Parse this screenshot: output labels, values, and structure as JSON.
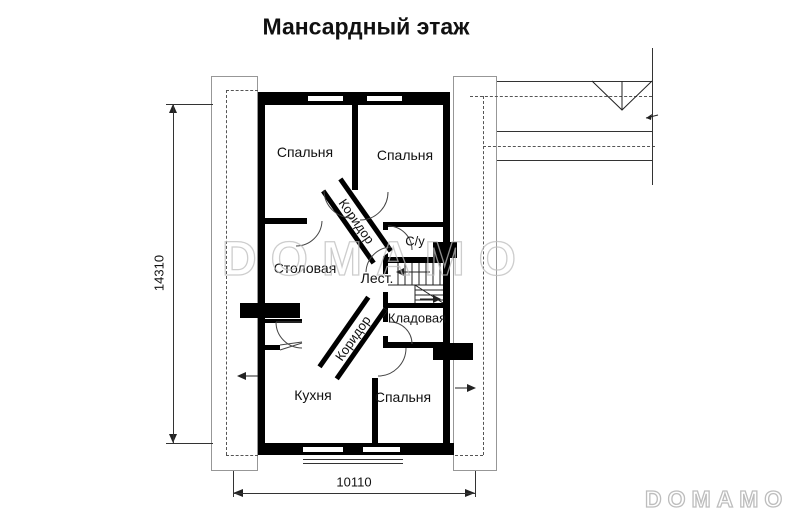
{
  "title": "Мансардный этаж",
  "rooms": {
    "bedroom_top_left": "Спальня",
    "bedroom_top_right": "Спальня",
    "dining": "Столовая",
    "bathroom": "С/у",
    "stairs": "Лест.",
    "storage": "Кладовая",
    "kitchen": "Кухня",
    "bedroom_bottom": "Спальня",
    "corridor_upper": "Коридор",
    "corridor_lower": "Коридор"
  },
  "dimensions": {
    "overall_depth": "14310",
    "overall_width": "10110"
  },
  "watermark": {
    "center": "DOMAMO",
    "corner": "DOMAMO"
  },
  "colors": {
    "wall": "#000000",
    "thin_line": "#333333",
    "watermark": "#bdbdbd"
  }
}
